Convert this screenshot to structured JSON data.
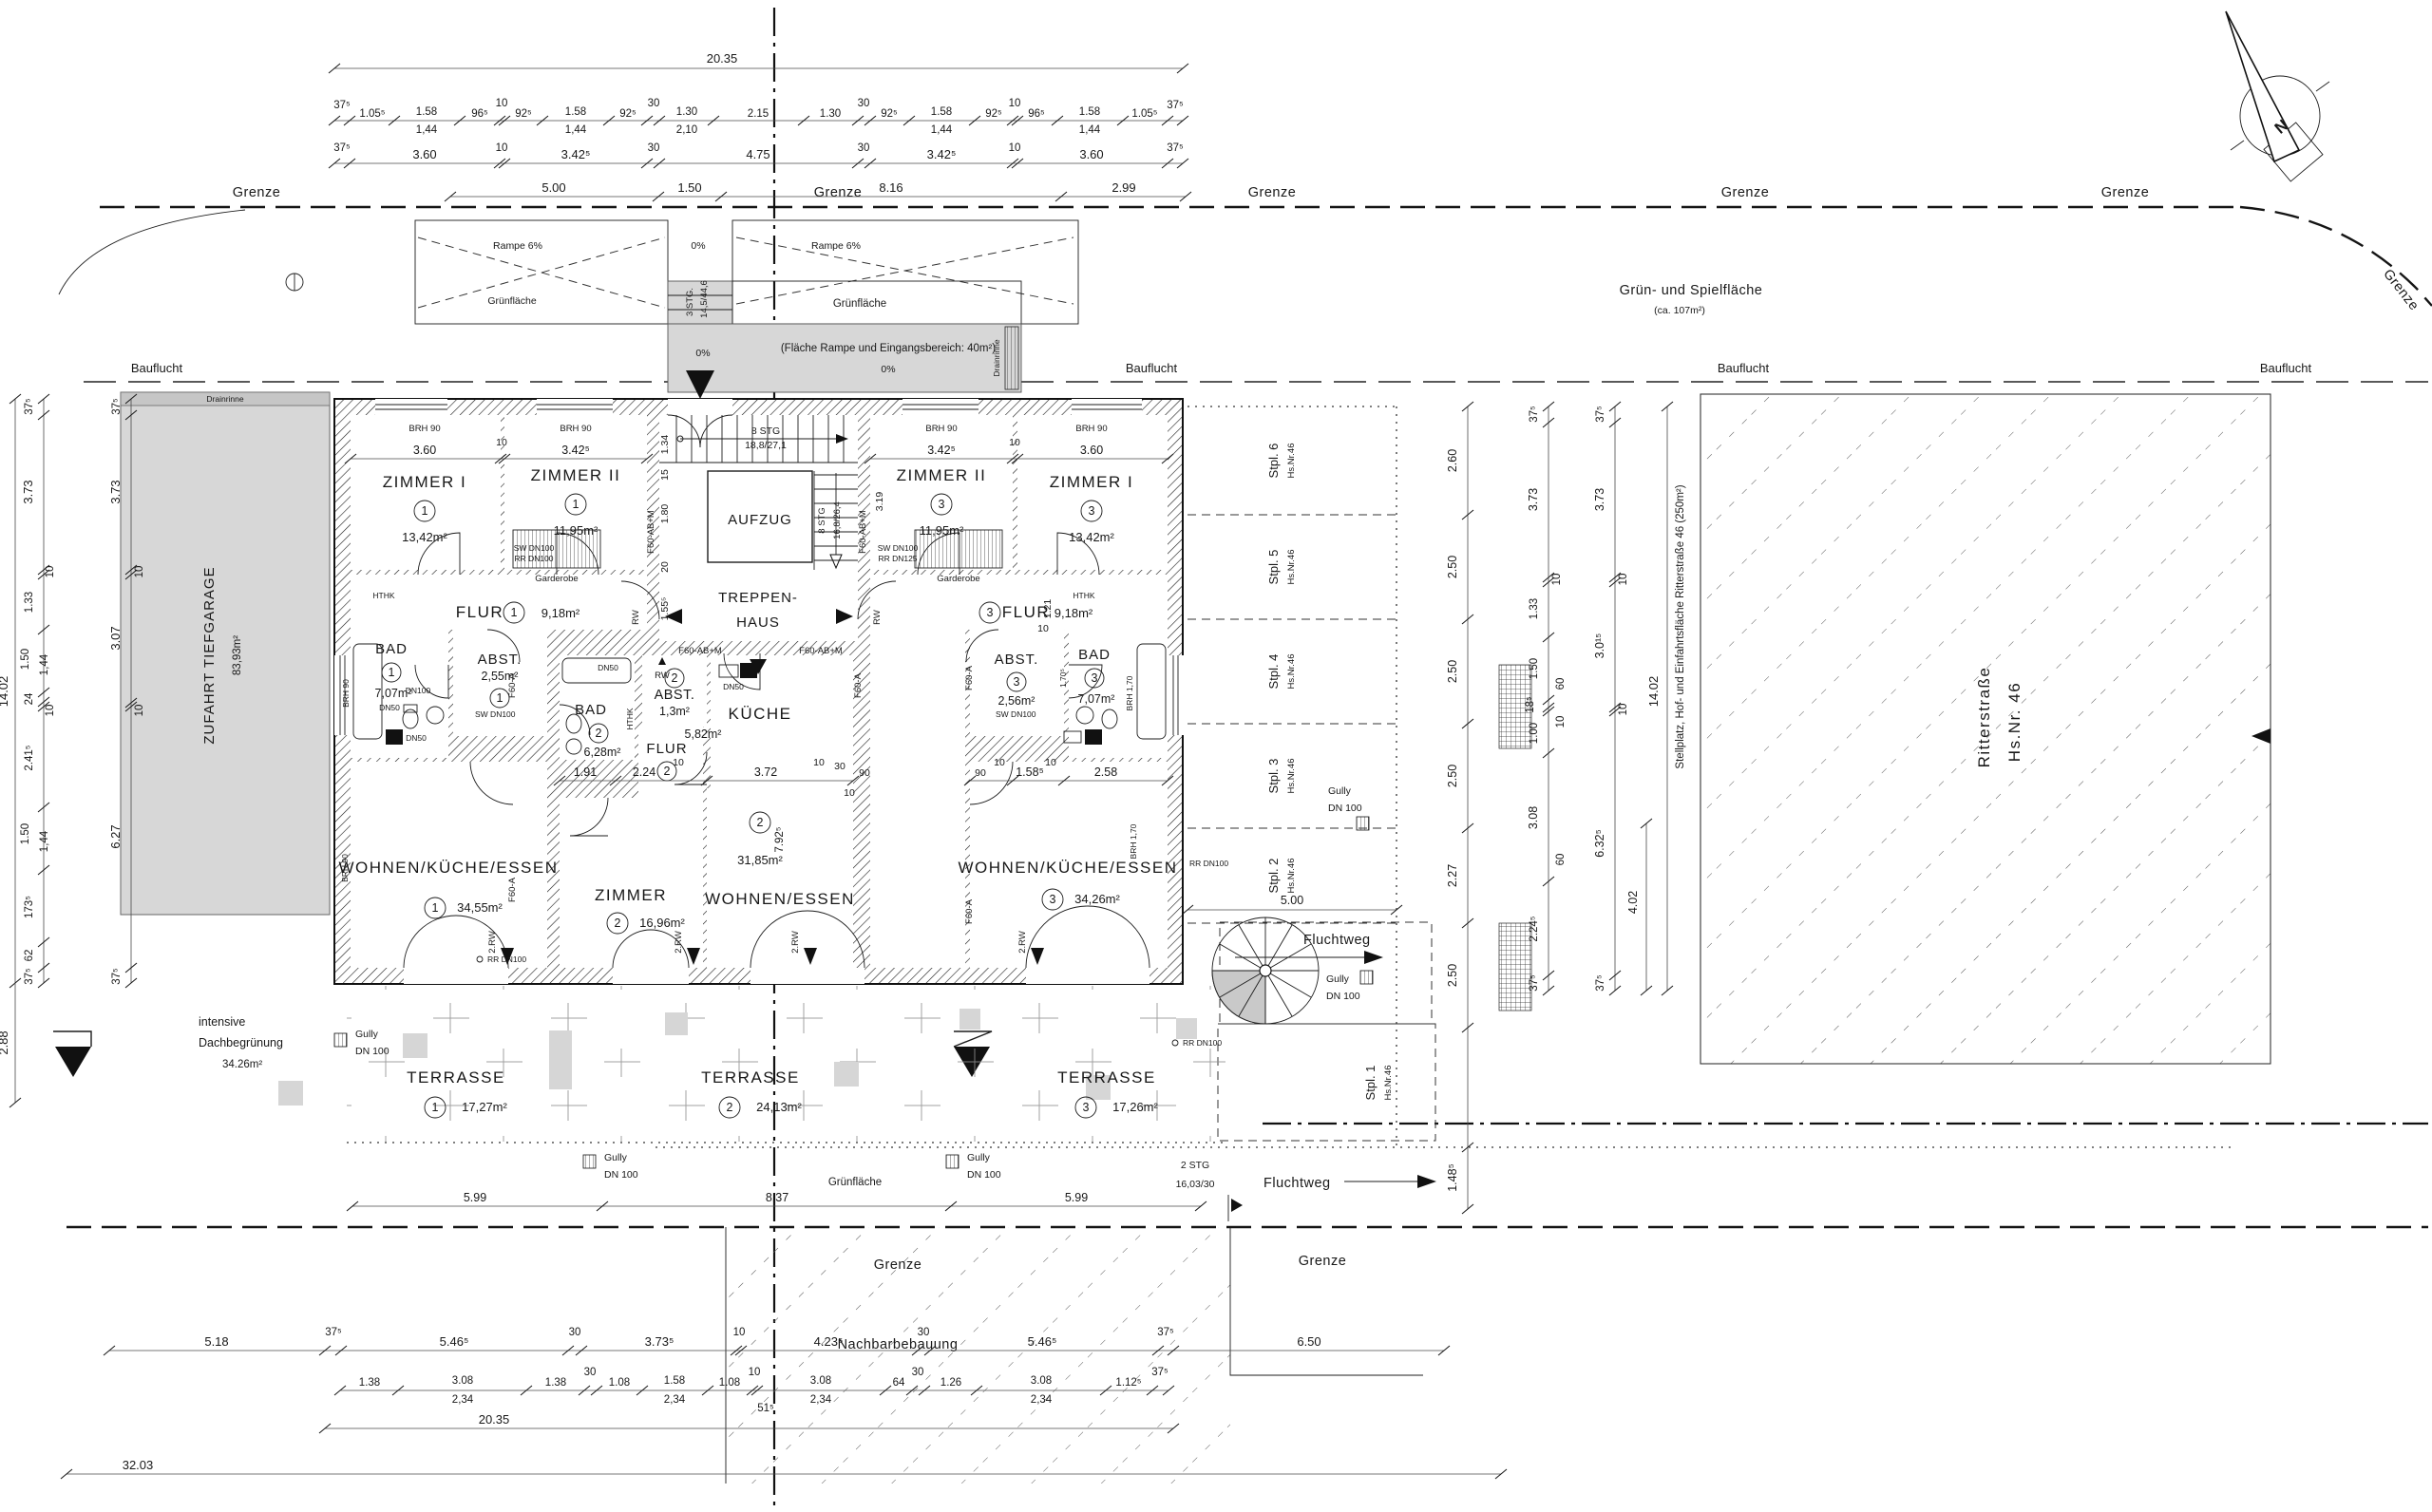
{
  "site": {
    "grenze": "Grenze",
    "bauflucht": "Bauflucht",
    "gruen": "Grünfläche",
    "rampe": "Rampe 6%",
    "p0": "0%",
    "flaeche": "(Fläche Rampe und Eingangsbereich: 40m²)",
    "stg3": "3 STG.",
    "stg3v": "14,5/44,6",
    "spiel1": "Grün- und Spielfläche",
    "spiel2": "(ca. 107m²)",
    "zufahrt": "ZUFAHRT TIEFGARAGE",
    "zufa": "83,93m²",
    "dach1": "intensive",
    "dach2": "Dachbegrünung",
    "dach3": "34.26m²",
    "nachbar": "Nachbarbebauung",
    "flucht": "Fluchtweg",
    "stg2": "2 STG",
    "stg2v": "16,03/30",
    "stell": "Stellplatz, Hof- und Einfahrtsfläche Ritterstraße 46 (250m²)",
    "rstr": "Ritterstraße",
    "hsnr": "Hs.Nr. 46",
    "north": "N"
  },
  "rooms": {
    "z1l": {
      "n": "ZIMMER I",
      "c": "1",
      "a": "13,42m²"
    },
    "z2l": {
      "n": "ZIMMER II",
      "c": "1",
      "a": "11,95m²"
    },
    "z2r": {
      "n": "ZIMMER II",
      "c": "3",
      "a": "11,95m²"
    },
    "z1r": {
      "n": "ZIMMER I",
      "c": "3",
      "a": "13,42m²"
    },
    "f1": {
      "n": "FLUR",
      "c": "1",
      "a": "9,18m²"
    },
    "f3": {
      "n": "FLUR",
      "c": "3",
      "a": "9,18m²"
    },
    "b1": {
      "n": "BAD",
      "c": "1",
      "a": "7,07m²"
    },
    "a1": {
      "n": "ABST.",
      "c": "1",
      "a": "2,55m²"
    },
    "b2": {
      "n": "BAD",
      "c": "2",
      "a": "6,28m²"
    },
    "a2": {
      "n": "ABST.",
      "c": "2",
      "a": "1,3m²"
    },
    "f2": {
      "n": "FLUR",
      "c": "2",
      "a": "5,82m²"
    },
    "ku": {
      "n": "KÜCHE"
    },
    "w1": {
      "n": "WOHNEN/KÜCHE/ESSEN",
      "c": "1",
      "a": "34,55m²"
    },
    "zi2": {
      "n": "ZIMMER",
      "c": "2",
      "a": "16,96m²"
    },
    "we2": {
      "n": "WOHNEN/ESSEN",
      "c": "2",
      "a": "31,85m²"
    },
    "w3": {
      "n": "WOHNEN/KÜCHE/ESSEN",
      "c": "3",
      "a": "34,26m²"
    },
    "b3": {
      "n": "BAD",
      "c": "3",
      "a": "7,07m²"
    },
    "a3": {
      "n": "ABST.",
      "c": "3",
      "a": "2,56m²"
    },
    "lift": "AUFZUG",
    "th1": "TREPPEN-",
    "th2": "HAUS",
    "s1": "8 STG",
    "s1v": "18,8/27,1",
    "s2": "8 STG",
    "s2v": "16,8/26,4",
    "t1": {
      "n": "TERRASSE",
      "c": "1",
      "a": "17,27m²"
    },
    "t2": {
      "n": "TERRASSE",
      "c": "2",
      "a": "24,13m²"
    },
    "t3": {
      "n": "TERRASSE",
      "c": "3",
      "a": "17,26m²"
    }
  },
  "stalls": [
    {
      "n": "Stpl. 6",
      "h": "Hs.Nr.46"
    },
    {
      "n": "Stpl. 5",
      "h": "Hs.Nr.46"
    },
    {
      "n": "Stpl. 4",
      "h": "Hs.Nr.46"
    },
    {
      "n": "Stpl. 3",
      "h": "Hs.Nr.46"
    },
    {
      "n": "Stpl. 2",
      "h": "Hs.Nr.46"
    },
    {
      "n": "Stpl. 1",
      "h": "Hs.Nr.46"
    }
  ],
  "ann": {
    "f60abm": "F60-AB+M",
    "f60a": "F60-A",
    "rw": "RW",
    "rw2": "2.RW",
    "gard": "Garderobe",
    "brh90": "BRH 90",
    "brh170": "BRH 1,70",
    "sw100": "SW DN100",
    "rr100": "RR DN100",
    "rr125": "RR DN125",
    "dn50": "DN50",
    "dn100": "DN100",
    "dn100s": "DN 100",
    "hthk": "HTHK",
    "gully": "Gully",
    "drain": "Drainrinne",
    "notue": "Notüberlauf",
    "rrdn100": "RR DN 100"
  },
  "dims": {
    "t1": [
      "20.35"
    ],
    "t2": [
      "37⁵",
      "1.05⁵",
      "1.58",
      "1,44",
      "96⁵",
      "10",
      "92⁵",
      "1.58",
      "1,44",
      "92⁵",
      "30",
      "1.30",
      "2,10",
      "2.15",
      "1.30",
      "30",
      "92⁵",
      "1.58",
      "1,44",
      "92⁵",
      "10",
      "96⁵",
      "1.58",
      "1,44",
      "1.05⁵",
      "37⁵"
    ],
    "t3": [
      "37⁵",
      "3.60",
      "10",
      "3.42⁵",
      "30",
      "4.75",
      "30",
      "3.42⁵",
      "10",
      "3.60",
      "37⁵"
    ],
    "t4": [
      "5.00",
      "1.50",
      "8.16",
      "2.99"
    ],
    "b1": [
      "5.18",
      "37⁵",
      "5.46⁵",
      "30",
      "3.73⁵",
      "10",
      "4.23⁵",
      "30",
      "5.46⁵",
      "37⁵",
      "6.50"
    ],
    "b2": [
      "1.38",
      "3.08",
      "2,34",
      "1.38",
      "30",
      "1.08",
      "1.58",
      "2,34",
      "1.08",
      "10",
      "51⁵",
      "3.08",
      "2,34",
      "64",
      "30",
      "1.26",
      "3.08",
      "2,34",
      "1.12⁵",
      "37⁵"
    ],
    "b3": [
      "20.35"
    ],
    "b4": [
      "32.03"
    ],
    "l1": [
      "37⁵",
      "3.73",
      "10",
      "1.33",
      "1.50",
      "1,44",
      "24",
      "10",
      "2.41⁵",
      "1.50",
      "1,44",
      "173⁵",
      "62",
      "37⁵",
      "14.02",
      "2.88"
    ],
    "l2": [
      "37⁵",
      "3.73",
      "10",
      "3.07",
      "10",
      "6.27",
      "37⁵"
    ],
    "r1": [
      "2.60",
      "2.50",
      "2.50",
      "2.50",
      "2.27",
      "2.50",
      "1.48⁵"
    ],
    "r2": [
      "37⁵",
      "3.73",
      "10",
      "1.33",
      "1.50",
      "60",
      "18⁵",
      "10",
      "1.00",
      "3.08",
      "60",
      "2.24⁵",
      "37⁵"
    ],
    "r3": [
      "37⁵",
      "3.73",
      "10",
      "3.0¹⁵",
      "10",
      "6.32⁵",
      "37⁵"
    ],
    "rt": [
      "14.02",
      "4.02"
    ],
    "tr": [
      "5.99",
      "8.37",
      "5.99"
    ],
    "in1": [
      "3.60",
      "10",
      "3.42⁵",
      "3.42⁵",
      "10",
      "3.60",
      "3.19"
    ],
    "in2": [
      "1.91",
      "2.24",
      "10",
      "3.72",
      "10",
      "30",
      "90",
      "10",
      "7.92⁵"
    ],
    "in3": [
      "90",
      "10",
      "1.58⁵",
      "10",
      "2.58"
    ],
    "core": [
      "1.34",
      "15",
      "1.80",
      "20",
      "1.55⁵",
      "1.21",
      "10"
    ],
    "st": [
      "5.00"
    ]
  }
}
